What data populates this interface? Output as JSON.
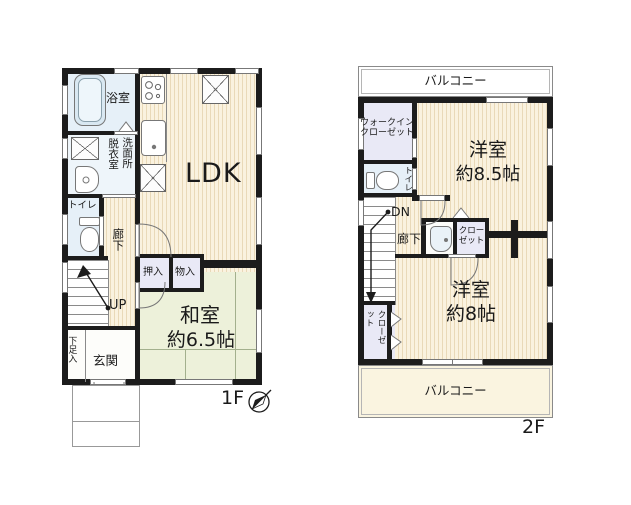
{
  "colors": {
    "wall": "#1c1c1c",
    "floor_cream": "#faf2df",
    "tatami_green": "#edf1da",
    "wet_blue": "#e6f0f8",
    "closet_lavender": "#e9e9f6",
    "balcony_cream": "#faf4e0"
  },
  "icons": {
    "bathtub": "bathtub-icon",
    "stove": "stove-icon",
    "kitchen_sink": "kitchen-sink-icon",
    "washer_space": "x-box-icon",
    "toilet": "toilet-icon",
    "washbasin": "washbasin-icon",
    "compass": "compass-icon",
    "stairs_up_arrow": "up-arrow-icon",
    "stairs_down_arrow": "down-arrow-icon"
  },
  "floor1": {
    "label": "1F",
    "ldk": "LDK",
    "bath": "浴室",
    "dressing": "脱衣室",
    "washroom": "洗面所",
    "toilet": "トイレ",
    "hall": "廊下",
    "up": "UP",
    "oshiire": "押入",
    "monoire": "物入",
    "washitsu": "和室",
    "washitsu_size": "約6.5帖",
    "shoe_box": "下足入",
    "entrance": "玄関"
  },
  "floor2": {
    "label": "2F",
    "balcony_top": "バルコニー",
    "balcony_bottom": "バルコニー",
    "wic_line1": "ウォークイン",
    "wic_line2": "クローゼット",
    "toilet": "トイレ",
    "dn": "DN",
    "hall": "廊下",
    "closet_mid_line1": "クロー",
    "closet_mid_line2": "ゼット",
    "room_a": "洋室",
    "room_a_size": "約8.5帖",
    "room_b": "洋室",
    "room_b_size": "約8帖",
    "closet_left": "クローゼット"
  }
}
